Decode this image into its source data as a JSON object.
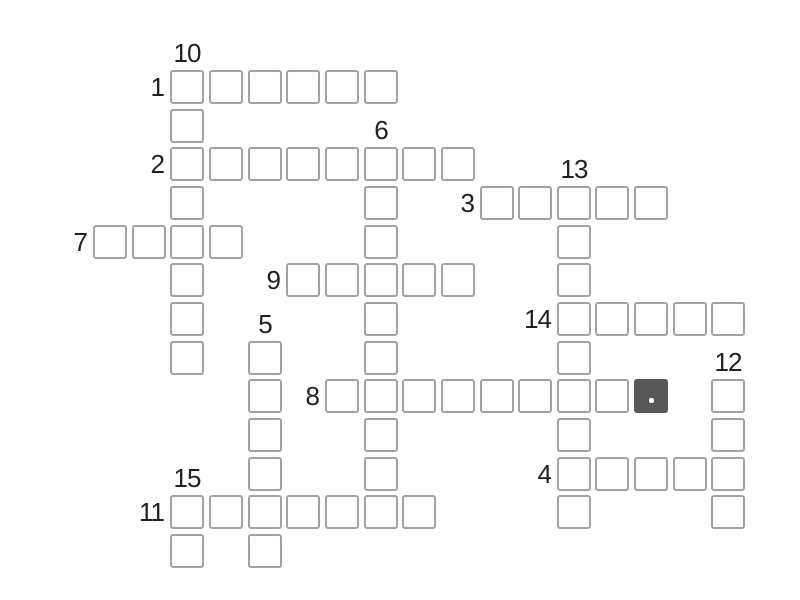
{
  "app": {
    "name": "crossword-puzzle",
    "background_color": "#ffffff"
  },
  "board": {
    "origin_x": 93,
    "origin_y": 70,
    "cell_size": 34,
    "cell_pitch": 38.65,
    "colors": {
      "cell_background": "#ffffff",
      "cell_border": "#a2a2a2",
      "selected_cell_background": "#58585a",
      "cursor_dot": "#ffffff",
      "clue_number_text": "#1f1f1f"
    },
    "selected_cell": {
      "col": 14,
      "row": 8,
      "word_number": 8
    },
    "words": [
      {
        "number": 1,
        "direction": "across",
        "col": 2,
        "row": 0,
        "length": 6
      },
      {
        "number": 2,
        "direction": "across",
        "col": 2,
        "row": 2,
        "length": 8
      },
      {
        "number": 3,
        "direction": "across",
        "col": 10,
        "row": 3,
        "length": 5
      },
      {
        "number": 4,
        "direction": "across",
        "col": 12,
        "row": 10,
        "length": 5
      },
      {
        "number": 5,
        "direction": "down",
        "col": 4,
        "row": 7,
        "length": 6
      },
      {
        "number": 6,
        "direction": "down",
        "col": 7,
        "row": 2,
        "length": 10
      },
      {
        "number": 7,
        "direction": "across",
        "col": 0,
        "row": 4,
        "length": 4
      },
      {
        "number": 8,
        "direction": "across",
        "col": 6,
        "row": 8,
        "length": 9
      },
      {
        "number": 9,
        "direction": "across",
        "col": 5,
        "row": 5,
        "length": 5
      },
      {
        "number": 10,
        "direction": "down",
        "col": 2,
        "row": 0,
        "length": 8
      },
      {
        "number": 11,
        "direction": "across",
        "col": 2,
        "row": 11,
        "length": 7
      },
      {
        "number": 12,
        "direction": "down",
        "col": 16,
        "row": 8,
        "length": 4
      },
      {
        "number": 13,
        "direction": "down",
        "col": 12,
        "row": 3,
        "length": 9
      },
      {
        "number": 14,
        "direction": "across",
        "col": 12,
        "row": 6,
        "length": 5
      },
      {
        "number": 15,
        "direction": "down",
        "col": 2,
        "row": 11,
        "length": 2
      }
    ]
  }
}
